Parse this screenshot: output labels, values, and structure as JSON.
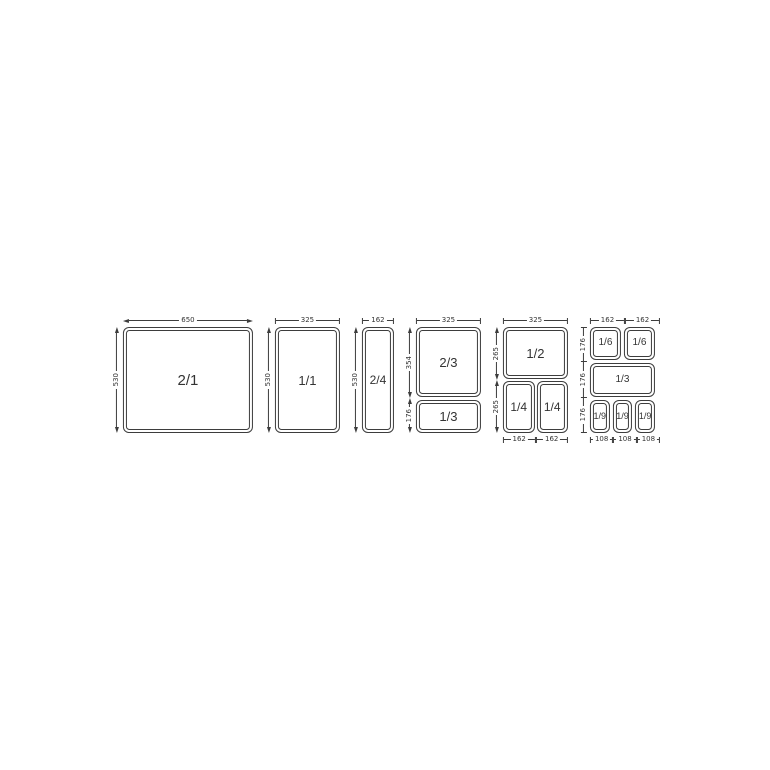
{
  "colors": {
    "line": "#3d3d3d",
    "text": "#333333",
    "background": "#ffffff"
  },
  "diagram_title": "Gastronorm pan size combinations",
  "figures": [
    {
      "name": "GN 2/1",
      "pans": [
        "2/1"
      ],
      "top_dims": [
        "650"
      ],
      "left_dims": [
        "530"
      ]
    },
    {
      "name": "GN 1/1",
      "pans": [
        "1/1"
      ],
      "top_dims": [
        "325"
      ],
      "left_dims": [
        "530"
      ]
    },
    {
      "name": "GN 2/4",
      "pans": [
        "2/4"
      ],
      "top_dims": [
        "162"
      ],
      "left_dims": [
        "530"
      ]
    },
    {
      "name": "GN 2/3 + 1/3",
      "pans": [
        "2/3",
        "1/3"
      ],
      "top_dims": [
        "325"
      ],
      "left_dims": [
        "354",
        "176"
      ]
    },
    {
      "name": "GN 1/2 + 1/4 + 1/4",
      "pans": [
        "1/2",
        "1/4",
        "1/4"
      ],
      "top_dims": [
        "325"
      ],
      "left_dims": [
        "265",
        "265"
      ],
      "bottom_dims": [
        "162",
        "162"
      ]
    },
    {
      "name": "GN 1/6 + 1/6 + 1/3 + 1/9 + 1/9 + 1/9",
      "pans": [
        "1/6",
        "1/6",
        "1/3",
        "1/9",
        "1/9",
        "1/9"
      ],
      "top_dims": [
        "162",
        "162"
      ],
      "left_dims": [
        "176",
        "176",
        "176"
      ],
      "bottom_dims": [
        "108",
        "108",
        "108"
      ]
    }
  ]
}
